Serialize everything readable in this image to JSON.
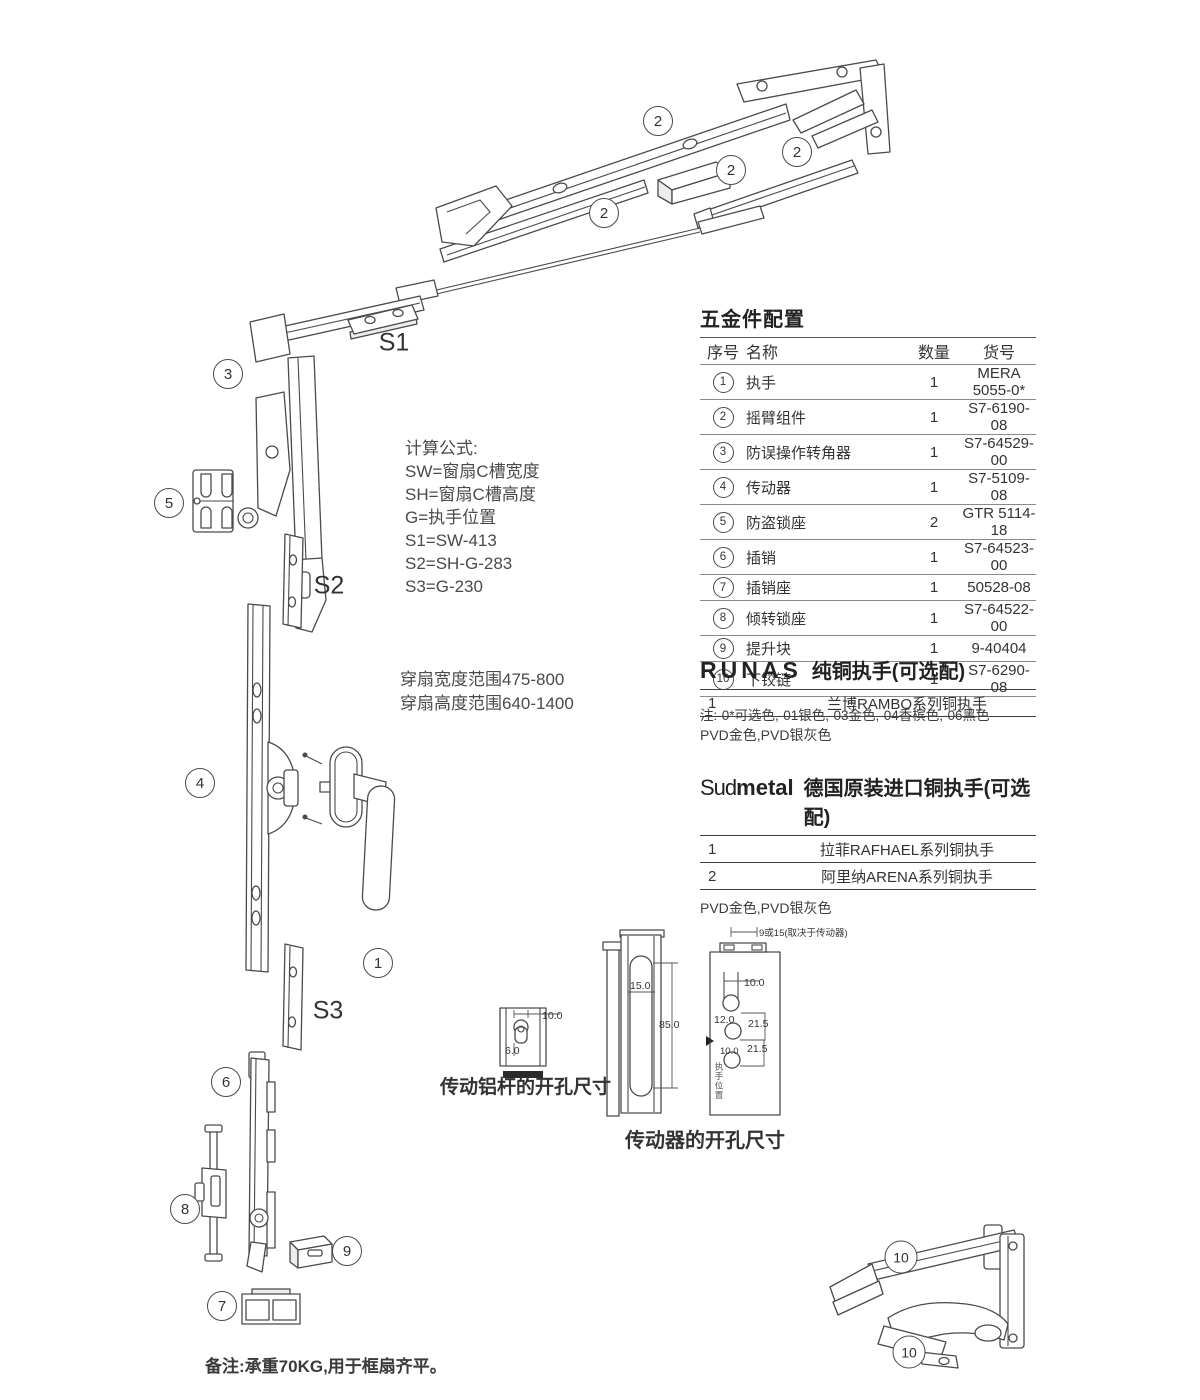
{
  "page": {
    "bg": "#ffffff",
    "ink": "#4a4a4a"
  },
  "callouts": {
    "arm_a": "2",
    "arm_b": "2",
    "arm_c": "2",
    "arm_d": "2",
    "corner": "3",
    "keeper": "5",
    "driver": "4",
    "handle": "1",
    "bolt": "6",
    "tilt_keeper": "8",
    "lift_block": "9",
    "bolt_keeper": "7",
    "hinge_a": "10",
    "hinge_b": "10",
    "s1": "S1",
    "s2": "S2",
    "s3": "S3"
  },
  "formulas": {
    "title": "计算公式:",
    "lines": [
      "SW=窗扇C槽宽度",
      "SH=窗扇C槽高度",
      "G=执手位置",
      "S1=SW-413",
      "S2=SH-G-283",
      "S3=G-230"
    ]
  },
  "range_lines": [
    "穿扇宽度范围475-800",
    "穿扇高度范围640-1400"
  ],
  "parts_table": {
    "title": "五金件配置",
    "headers": [
      "序号",
      "名称",
      "数量",
      "货号"
    ],
    "rows": [
      {
        "no": "1",
        "name": "执手",
        "qty": "1",
        "code": "MERA 5055-0*"
      },
      {
        "no": "2",
        "name": "摇臂组件",
        "qty": "1",
        "code": "S7-6190-08"
      },
      {
        "no": "3",
        "name": "防误操作转角器",
        "qty": "1",
        "code": "S7-64529-00"
      },
      {
        "no": "4",
        "name": "传动器",
        "qty": "1",
        "code": "S7-5109-08"
      },
      {
        "no": "5",
        "name": "防盗锁座",
        "qty": "2",
        "code": "GTR 5114-18"
      },
      {
        "no": "6",
        "name": "插销",
        "qty": "1",
        "code": "S7-64523-00"
      },
      {
        "no": "7",
        "name": "插销座",
        "qty": "1",
        "code": "50528-08"
      },
      {
        "no": "8",
        "name": "倾转锁座",
        "qty": "1",
        "code": "S7-64522-00"
      },
      {
        "no": "9",
        "name": "提升块",
        "qty": "1",
        "code": "9-40404"
      },
      {
        "no": "10",
        "name": "下铰链",
        "qty": "1",
        "code": "S7-6290-08"
      }
    ],
    "note": "注:-0*可选色,-01银色,-03金色,-04香槟色,-06黑色"
  },
  "runas": {
    "brand": "RUNAS",
    "title": "纯铜执手(可选配)",
    "rows": [
      {
        "no": "1",
        "name": "兰博RAMBO系列铜执手"
      }
    ],
    "note": "PVD金色,PVD银灰色"
  },
  "sudmetal": {
    "brand_prefix": "Sud",
    "brand_suffix": "metal",
    "title": "德国原装进口铜执手(可选配)",
    "rows": [
      {
        "no": "1",
        "name": "拉菲RAFHAEL系列铜执手"
      },
      {
        "no": "2",
        "name": "阿里纳ARENA系列铜执手"
      }
    ],
    "note": "PVD金色,PVD银灰色"
  },
  "dims": {
    "rod_label": "传动铝杆的开孔尺寸",
    "rod_w": "10.0",
    "rod_h": "6.0",
    "driver_label": "传动器的开孔尺寸",
    "slot_w": "15.0",
    "slot_h": "85.0",
    "plate_top": "9或15(取决于传动器)",
    "p1": "10.0",
    "p2": "12.0",
    "p3": "21.5",
    "p4": "21.5",
    "p5": "10.0",
    "vtext": "执手位置"
  },
  "footnote": "备注:承重70KG,用于框扇齐平。"
}
